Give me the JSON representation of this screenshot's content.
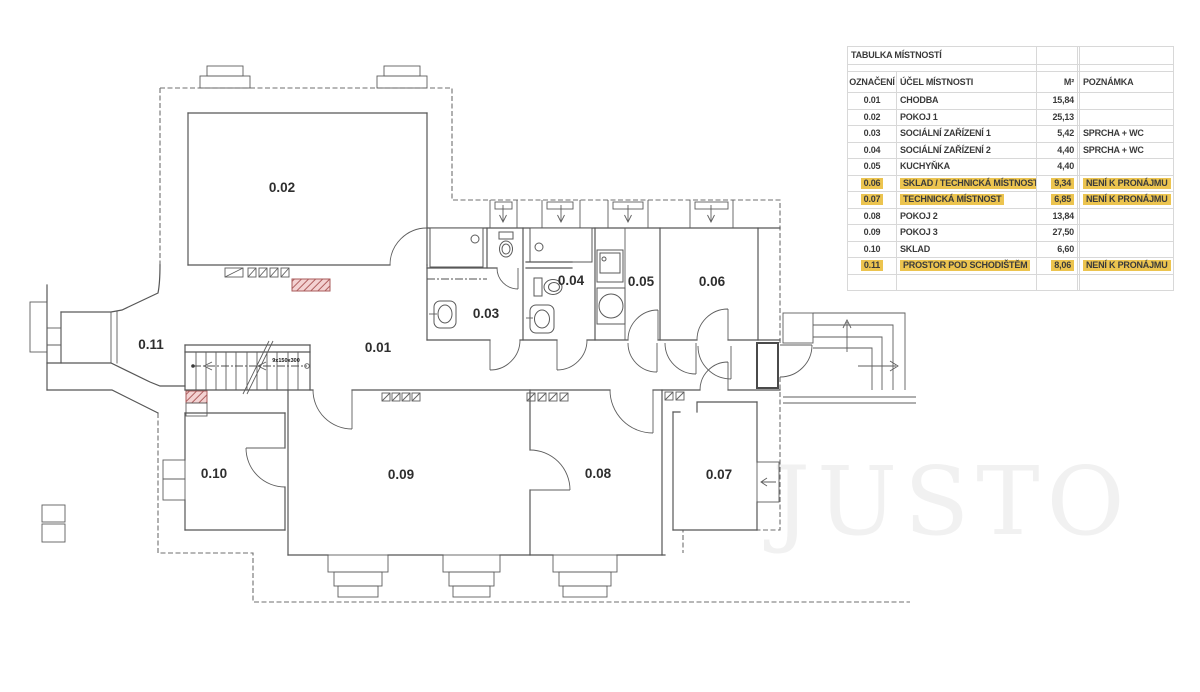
{
  "table": {
    "title": "TABULKA MÍSTNOSTÍ",
    "columns": [
      "OZNAČENÍ",
      "ÚČEL MÍSTNOSTI",
      "M²",
      "POZNÁMKA"
    ],
    "rows": [
      {
        "id": "0.01",
        "name": "CHODBA",
        "area": "15,84",
        "note": "",
        "highlight": false
      },
      {
        "id": "0.02",
        "name": "POKOJ 1",
        "area": "25,13",
        "note": "",
        "highlight": false
      },
      {
        "id": "0.03",
        "name": "SOCIÁLNÍ ZAŘÍZENÍ 1",
        "area": "5,42",
        "note": "SPRCHA + WC",
        "highlight": false
      },
      {
        "id": "0.04",
        "name": "SOCIÁLNÍ ZAŘÍZENÍ 2",
        "area": "4,40",
        "note": "SPRCHA + WC",
        "highlight": false
      },
      {
        "id": "0.05",
        "name": "KUCHYŇKA",
        "area": "4,40",
        "note": "",
        "highlight": false
      },
      {
        "id": "0.06",
        "name": "SKLAD / TECHNICKÁ MÍSTNOST",
        "area": "9,34",
        "note": "NENÍ K PRONÁJMU",
        "highlight": true
      },
      {
        "id": "0.07",
        "name": "TECHNICKÁ MÍSTNOST",
        "area": "6,85",
        "note": "NENÍ K PRONÁJMU",
        "highlight": true
      },
      {
        "id": "0.08",
        "name": "POKOJ 2",
        "area": "13,84",
        "note": "",
        "highlight": false
      },
      {
        "id": "0.09",
        "name": "POKOJ 3",
        "area": "27,50",
        "note": "",
        "highlight": false
      },
      {
        "id": "0.10",
        "name": "SKLAD",
        "area": "6,60",
        "note": "",
        "highlight": false
      },
      {
        "id": "0.11",
        "name": "PROSTOR POD SCHODIŠTĚM",
        "area": "8,06",
        "note": "NENÍ K PRONÁJMU",
        "highlight": true
      }
    ]
  },
  "plan": {
    "room_labels": [
      {
        "id": "0.01",
        "x": 378,
        "y": 352
      },
      {
        "id": "0.02",
        "x": 282,
        "y": 192
      },
      {
        "id": "0.03",
        "x": 486,
        "y": 318
      },
      {
        "id": "0.04",
        "x": 571,
        "y": 285
      },
      {
        "id": "0.05",
        "x": 641,
        "y": 286
      },
      {
        "id": "0.06",
        "x": 712,
        "y": 286
      },
      {
        "id": "0.07",
        "x": 719,
        "y": 479
      },
      {
        "id": "0.08",
        "x": 598,
        "y": 478
      },
      {
        "id": "0.09",
        "x": 401,
        "y": 479
      },
      {
        "id": "0.10",
        "x": 214,
        "y": 478
      },
      {
        "id": "0.11",
        "x": 151,
        "y": 349
      }
    ],
    "stair_annotation": "9x150x300"
  },
  "watermark": {
    "text": "JUSTO"
  },
  "colors": {
    "highlight": "#ECC44F",
    "wall": "#565656",
    "chimney_fill": "#F3D2D2",
    "chimney_stroke": "#A85B5B",
    "table_border": "#D8D8D8",
    "text": "#3A3A3A",
    "watermark": "#F1F1F1"
  }
}
